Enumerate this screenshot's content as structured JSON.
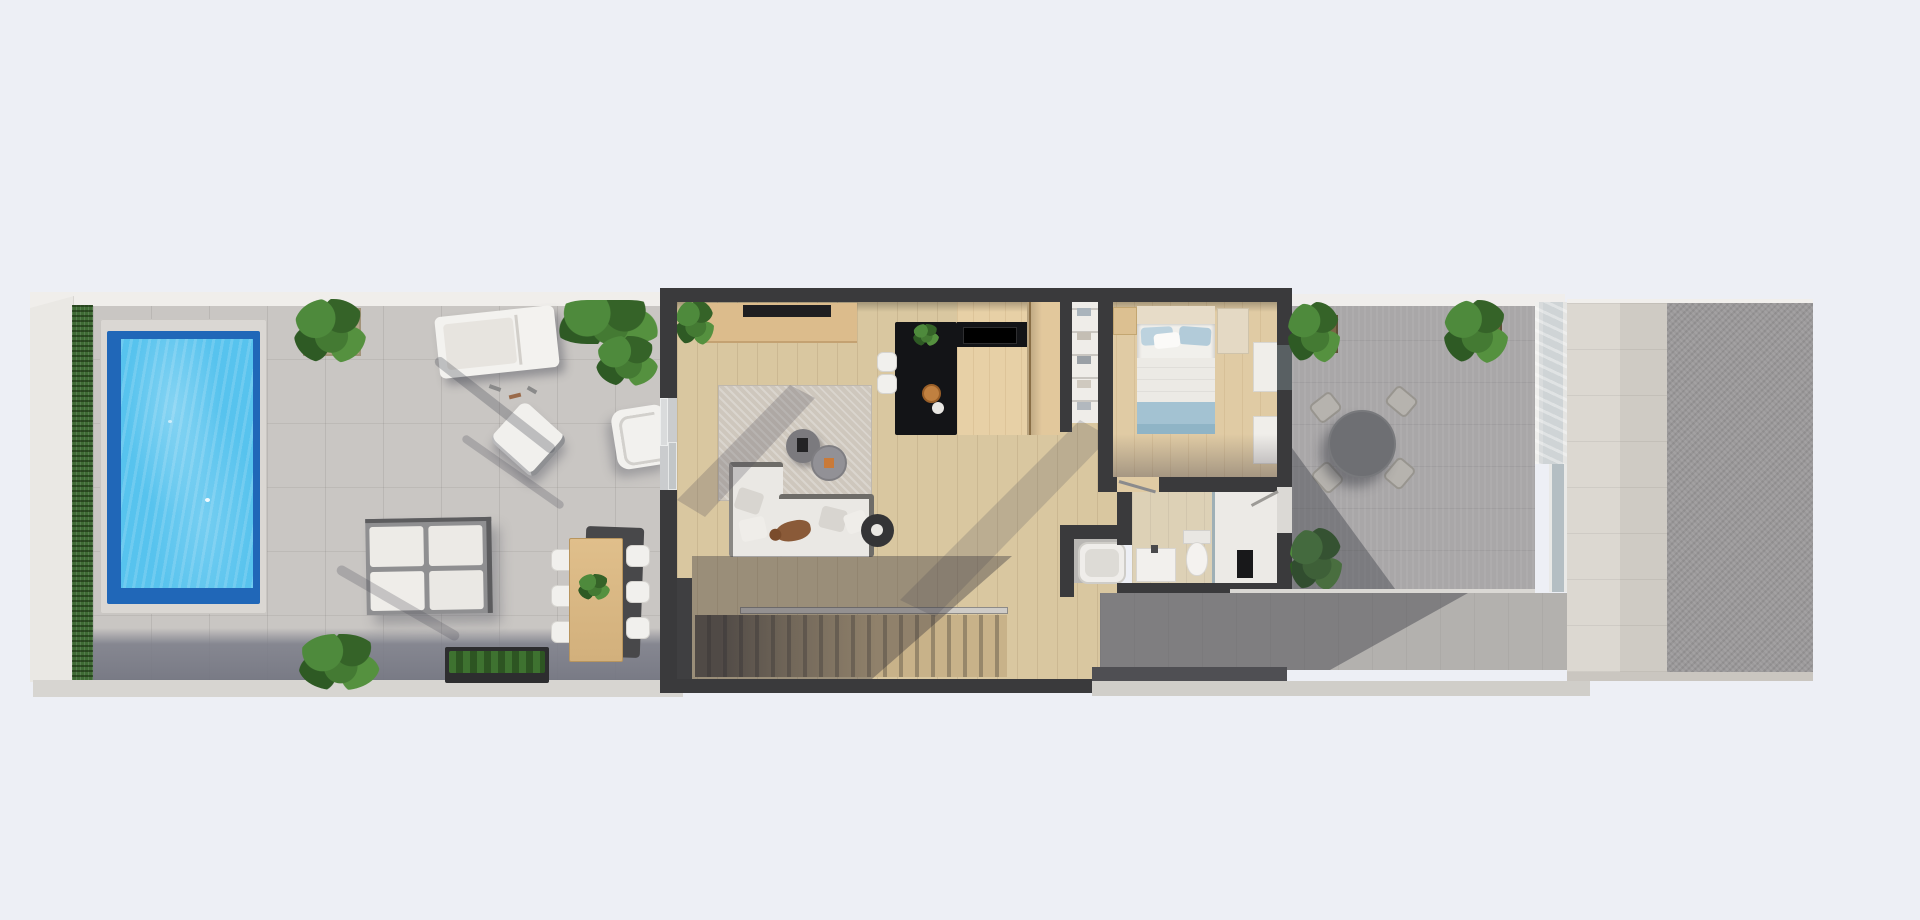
{
  "meta": {
    "caption": "Top-down 3D architectural floor plan render of a narrow villa: pool terrace on the left, open-plan living/kitchen, bedroom and bathroom in the middle, paved patio on the right.",
    "background_color": "#edeff5"
  },
  "palette": {
    "wall_dark": "#3a3a3c",
    "terrace_paving": "#c9c6c3",
    "terrace_shadow": "#7a7c88",
    "hedge_green": "#3f6b35",
    "pool_water": "#57c3ee",
    "pool_border": "#2067b8",
    "pool_coping": "#dad7d3",
    "wood_floor": "#d9c7a0",
    "kitchen_island": "#131417",
    "wood_furniture": "#dcbc8c",
    "sofa_white": "#eae8e4",
    "bed_blue": "#a9c6d6",
    "patio_paving": "#a9a7a8",
    "stone_strip": "#d8d4cd",
    "gravel_block": "#9b999a",
    "walkway": "#d7d5d1"
  },
  "scene": {
    "left_terrace": {
      "label": "Pool terrace",
      "objects": [
        "swimming-pool",
        "privacy-hedge",
        "roof-edge",
        "planter-with-plant",
        "sun-lounger",
        "lounge-chair",
        "outdoor-armchair",
        "four-piece-seating-set",
        "outdoor-dining-table-with-six-chairs",
        "planter-box",
        "corner-plants",
        "tree-shadows"
      ]
    },
    "house": {
      "label": "Open-plan interior",
      "rooms": [
        {
          "name": "living-room",
          "objects": [
            "tv-console",
            "tv",
            "area-rug",
            "l-shaped-sofa",
            "dog-on-sofa",
            "round-coffee-tables",
            "round-side-table",
            "indoor-plant"
          ]
        },
        {
          "name": "kitchen",
          "objects": [
            "black-island",
            "bar-stools",
            "black-back-counter",
            "tall-wood-cabinets",
            "fruit-bowl"
          ]
        },
        {
          "name": "wardrobe-closet",
          "objects": [
            "open-shelving"
          ]
        },
        {
          "name": "bedroom",
          "objects": [
            "double-bed-blue-bedding",
            "headboard",
            "bedside-table",
            "foot-bench",
            "wall-cabinets"
          ]
        },
        {
          "name": "bathroom",
          "objects": [
            "vanity-sink",
            "toilet",
            "walk-in-shower",
            "glass-screen",
            "bathtub-niche"
          ]
        },
        {
          "name": "staircase",
          "objects": [
            "stair-treads",
            "railing",
            "stairwell-wall"
          ]
        }
      ]
    },
    "right_terrace": {
      "label": "Entry patio",
      "objects": [
        "round-patio-table",
        "four-patio-chairs",
        "corner-plants",
        "glass-balustrade",
        "entry-door",
        "wall-cabinets-exterior"
      ]
    },
    "surroundings": {
      "label": "Adjacent surfaces",
      "objects": [
        "stone-wall-strip",
        "gravel-roof-block",
        "perimeter-walkway"
      ]
    }
  }
}
